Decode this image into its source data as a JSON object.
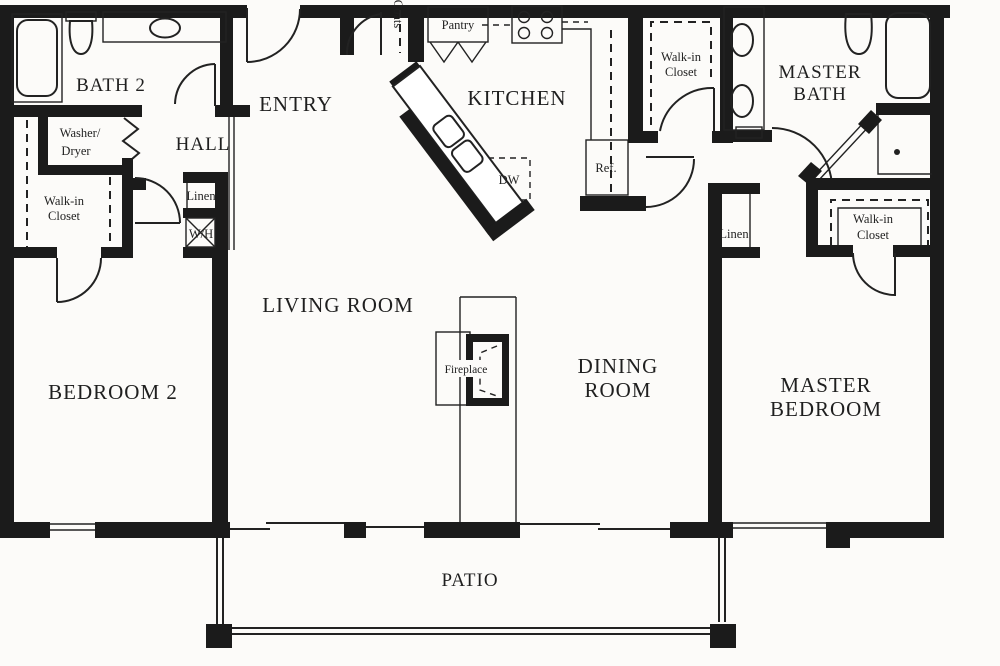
{
  "colors": {
    "paper": "#fcfbf9",
    "wall": "#1b1b1b",
    "line": "#222222"
  },
  "rooms": {
    "bath2": "BATH 2",
    "hall": "HALL",
    "entry": "ENTRY",
    "kitchen": "KITCHEN",
    "living_room": "LIVING ROOM",
    "dining_line1": "DINING",
    "dining_line2": "ROOM",
    "bedroom2": "BEDROOM 2",
    "master_bedroom_line1": "MASTER",
    "master_bedroom_line2": "BEDROOM",
    "master_bath_line1": "MASTER",
    "master_bath_line2": "BATH",
    "patio": "PATIO"
  },
  "features": {
    "coats": "Coats",
    "pantry": "Pantry",
    "washer_line1": "Washer/",
    "washer_line2": "Dryer",
    "walkin_line1": "Walk-in",
    "walkin_line2": "Closet",
    "linen": "Linen",
    "water_heater": "W/H",
    "refrigerator": "Ref.",
    "dishwasher": "DW",
    "fireplace": "Fireplace"
  }
}
